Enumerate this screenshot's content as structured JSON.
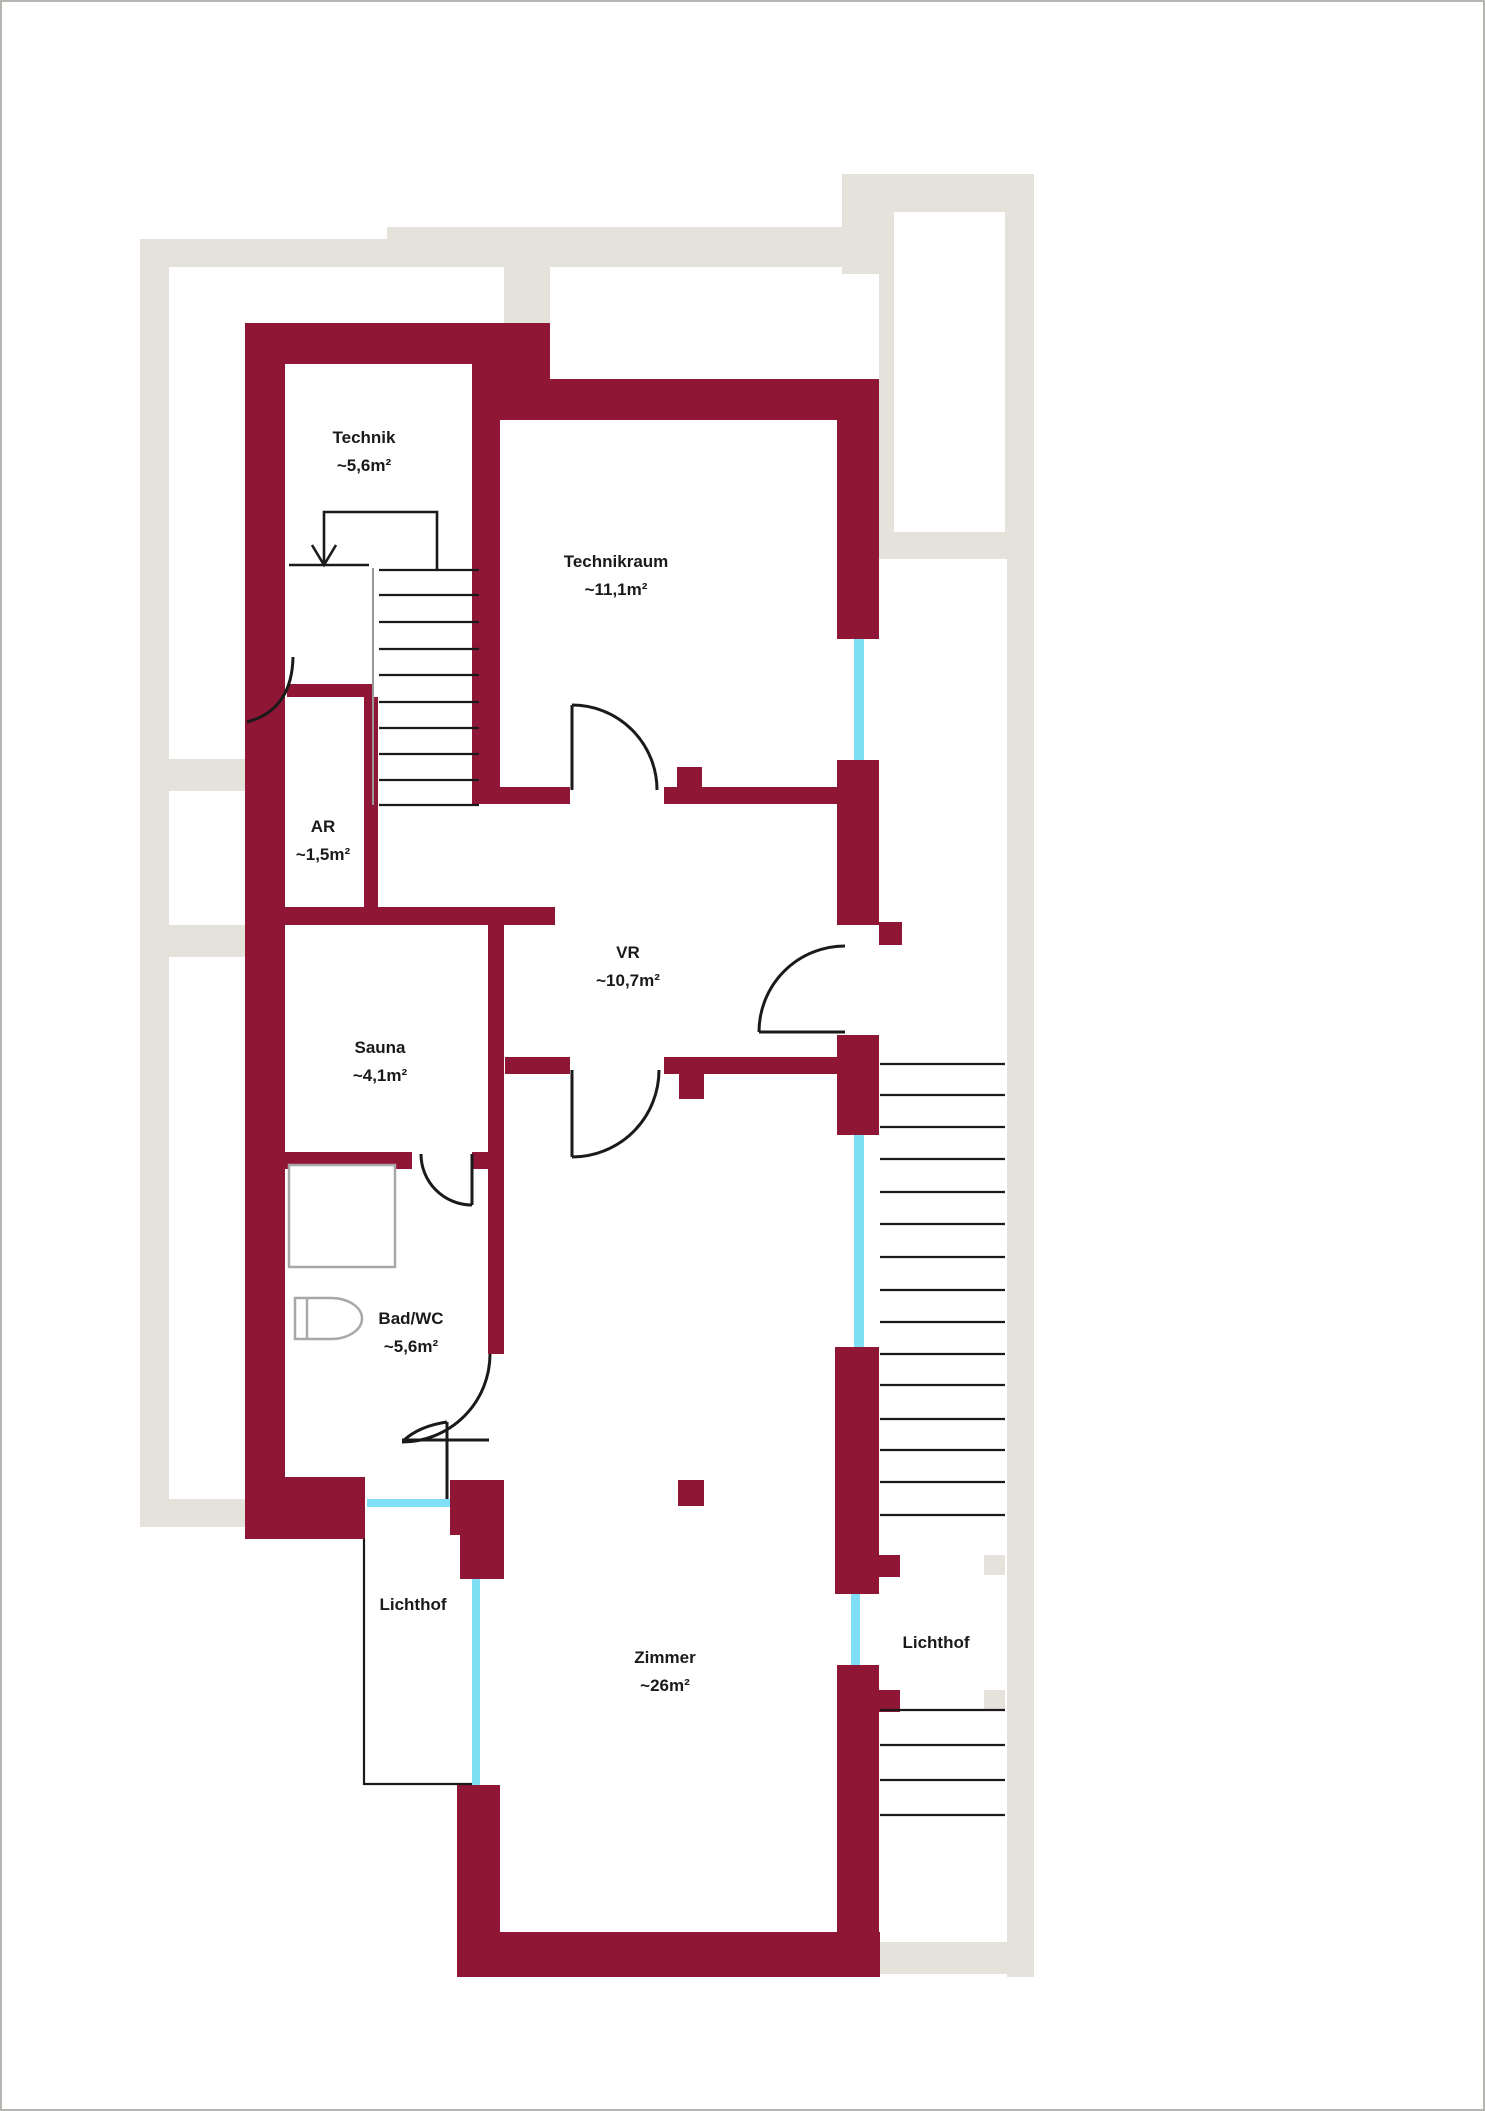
{
  "plan": {
    "rooms": [
      {
        "name": "Technik",
        "area": "~5,6m²"
      },
      {
        "name": "Technikraum",
        "area": "~11,1m²"
      },
      {
        "name": "AR",
        "area": "~1,5m²"
      },
      {
        "name": "VR",
        "area": "~10,7m²"
      },
      {
        "name": "Sauna",
        "area": "~4,1m²"
      },
      {
        "name": "Bad/WC",
        "area": "~5,6m²"
      },
      {
        "name": "Zimmer",
        "area": "~26m²"
      }
    ],
    "courtyards": [
      {
        "name": "Lichthof"
      },
      {
        "name": "Lichthof"
      }
    ],
    "colors": {
      "wall": "#901636",
      "existing_structure": "#e4e2da",
      "window": "#7fdff5",
      "linework": "#1a1a1a",
      "fixture": "#a8a8a8"
    }
  }
}
